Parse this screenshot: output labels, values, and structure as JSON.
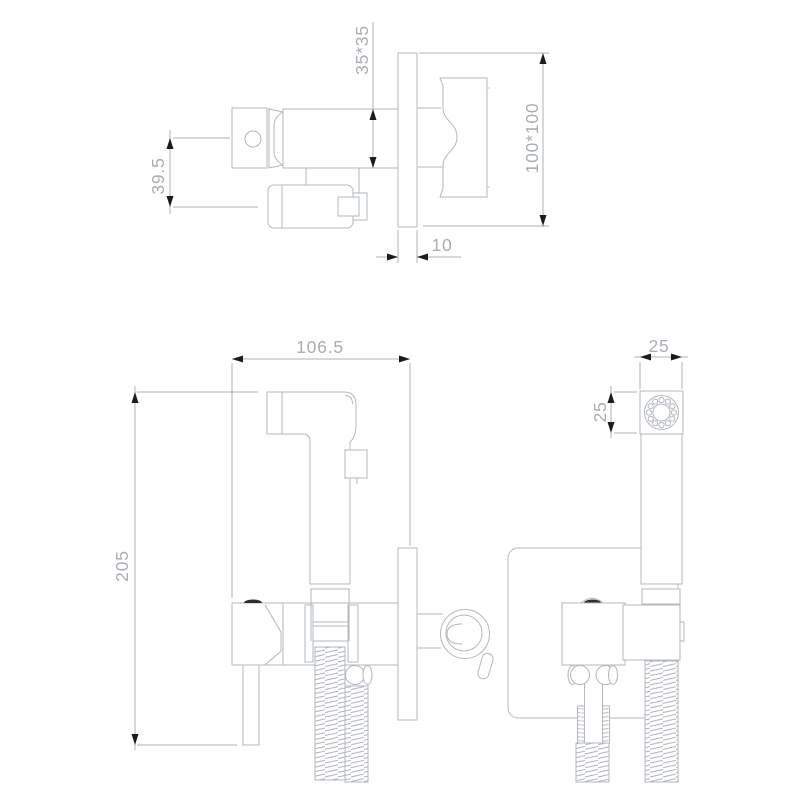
{
  "drawing": {
    "type": "technical-cad-drawing",
    "subject": "wall-mounted bidet sprayer mixer, side and front projections",
    "colors": {
      "background": "#ffffff",
      "part_line": "#b3b8be",
      "dim_line": "#adb2b8",
      "dim_text": "#a9aeb5",
      "arrow": "#1c1c1c",
      "dark_detail": "#2e2e2e"
    },
    "dimensions": {
      "body_section": "35*35",
      "spout_offset": "39.5",
      "wall_plate_size": "100*100",
      "plate_thickness": "10",
      "overall_depth": "106.5",
      "sprayer_head_width": "25",
      "sprayer_head_height": "25",
      "overall_height": "205"
    }
  }
}
